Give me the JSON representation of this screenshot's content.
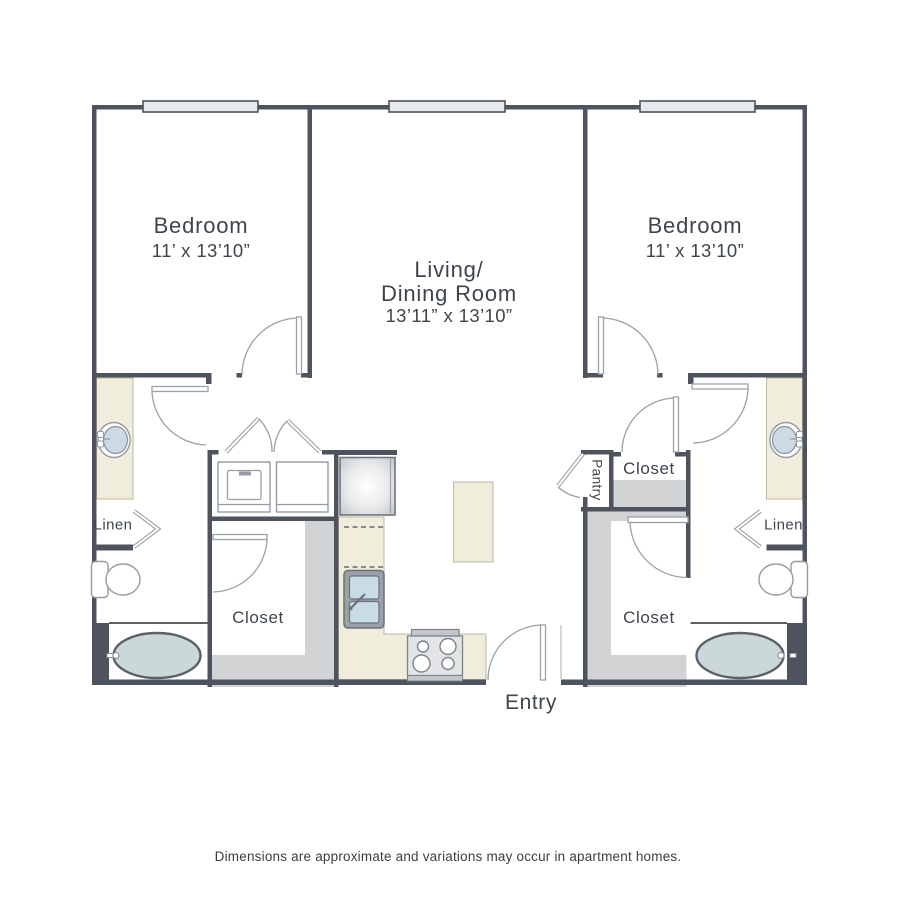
{
  "floorplan": {
    "rooms": {
      "bedroom_left": {
        "name": "Bedroom",
        "dimensions": "11’ x 13’10”"
      },
      "bedroom_right": {
        "name": "Bedroom",
        "dimensions": "11’ x 13’10”"
      },
      "living_dining": {
        "name_line1": "Living/",
        "name_line2": "Dining Room",
        "dimensions": "13’11” x 13’10”"
      },
      "closet_upper_right": {
        "name": "Closet"
      },
      "closet_lower_left": {
        "name": "Closet"
      },
      "closet_lower_right": {
        "name": "Closet"
      },
      "linen_left": {
        "name": "Linen"
      },
      "linen_right": {
        "name": "Linen"
      },
      "pantry": {
        "name": "Pantry"
      },
      "entry": {
        "name": "Entry"
      }
    },
    "fixtures": [
      "window",
      "bathtub",
      "toilet",
      "vanity-sink",
      "washer",
      "dryer",
      "refrigerator",
      "kitchen-sink",
      "stove",
      "kitchen-island",
      "bifold-doors",
      "door-swing",
      "linen-door",
      "pantry-door"
    ],
    "colors": {
      "wall": "#4d545d",
      "counter_beige": "#f0eddc",
      "floor_gray": "#d2d3d5",
      "fixture_blue": "#ccdae3",
      "door_line": "#9aa1a8",
      "window_fill": "#e6e9eb"
    },
    "disclaimer": "Dimensions are approximate and variations may occur in apartment homes."
  }
}
